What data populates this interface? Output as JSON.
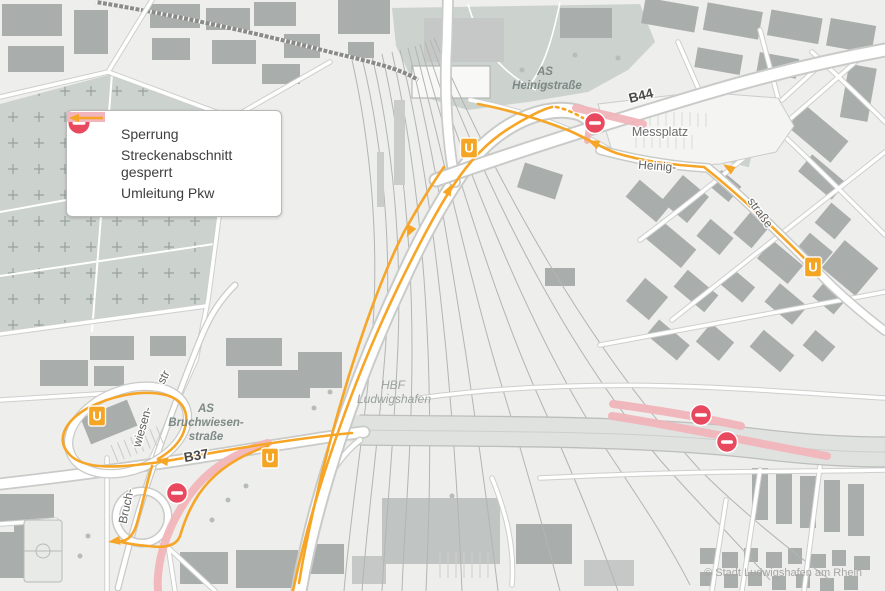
{
  "legend": {
    "items": [
      {
        "icon": "no-entry-icon",
        "label": "Sperrung"
      },
      {
        "icon": "closed-segment-icon",
        "label": "Streckenabschnitt gesperrt",
        "label_line1": "Streckenabschnitt",
        "label_line2": "gesperrt"
      },
      {
        "icon": "detour-arrow-icon",
        "label": "Umleitung Pkw"
      }
    ]
  },
  "map_labels": {
    "as_heinigstrasse_line1": "AS",
    "as_heinigstrasse_line2": "Heinigstraße",
    "b44": "B44",
    "messplatz": "Messplatz",
    "heinig": "Heinig-",
    "strasse": "straße",
    "hbf_line1": "HBF",
    "hbf_line2": "Ludwigshafen",
    "as_bruchwiesen_line1": "AS",
    "as_bruchwiesen_line2": "Bruchwiesen-",
    "as_bruchwiesen_line3": "straße",
    "b37": "B37",
    "bruch": "Bruch-",
    "wiesen": "wiesen-",
    "str": "str",
    "copyright": "© Stadt Ludwigshafen am Rhein"
  },
  "markers": {
    "u_station_label": "U",
    "u_station_count": 4,
    "u_positions": [
      [
        469,
        148
      ],
      [
        813,
        267
      ],
      [
        97,
        416
      ],
      [
        270,
        458
      ]
    ],
    "no_entry_map_count": 4,
    "no_entry_positions": [
      [
        595,
        123
      ],
      [
        701,
        415
      ],
      [
        727,
        442
      ],
      [
        177,
        493
      ]
    ]
  },
  "colors": {
    "background": "#eeeeec",
    "building_dark": "#a9aeac",
    "building_mid": "#c5c8c6",
    "green_area": "#ccd2ce",
    "road_fill": "#ffffff",
    "road_casing": "#c9cbc9",
    "railway": "#b3b5b3",
    "highway_deck": "#e0e2e0",
    "closure_pink": "#f1b5bb",
    "detour_orange": "#f6a527",
    "no_entry_red": "#e8495f",
    "legend_text": "#3e3e3e"
  }
}
